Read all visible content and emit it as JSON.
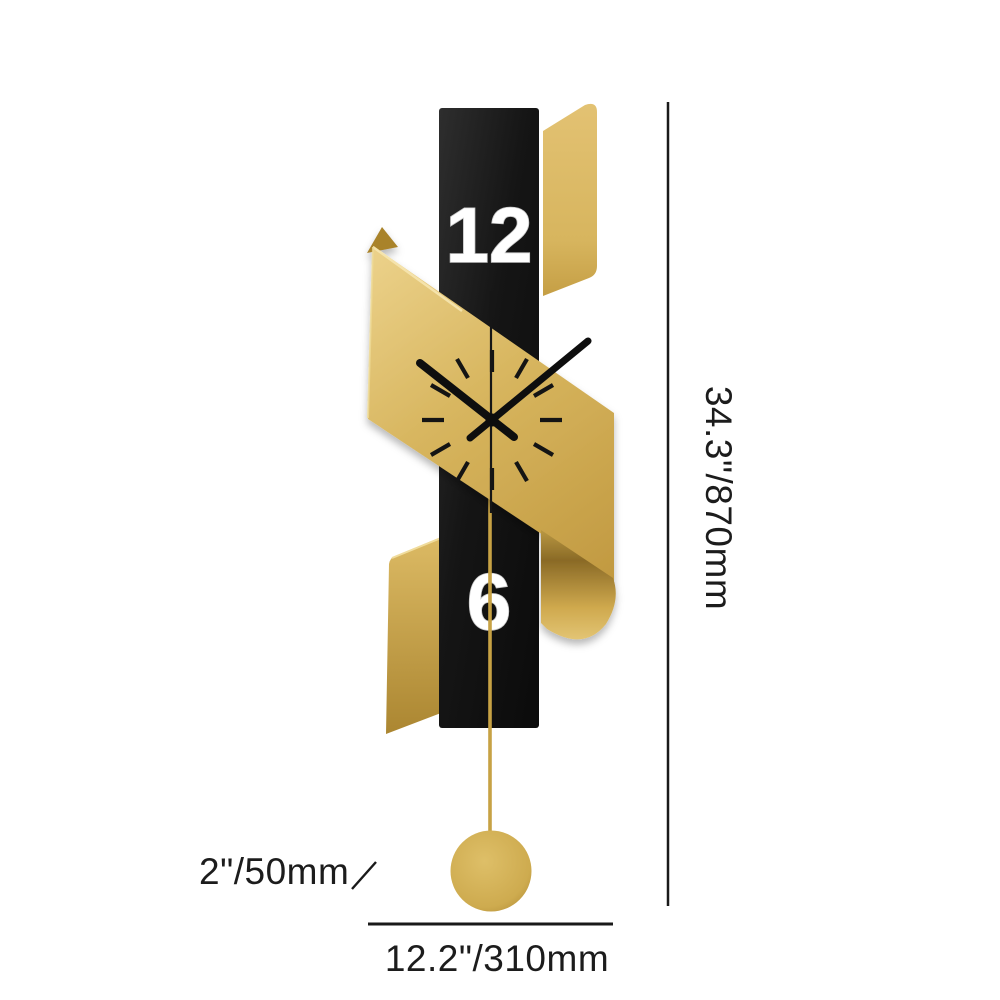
{
  "clock": {
    "numeral_top": "12",
    "numeral_bottom": "6",
    "colors": {
      "gold": "#d2ae56",
      "gold_light": "#ecd28b",
      "gold_dark": "#a8832f",
      "body_black": "#141414",
      "numeral_white": "#ffffff"
    }
  },
  "annotations": {
    "height_label": "34.3\"/870mm",
    "width_label": "12.2\"/310mm",
    "pendulum_label": "2\"/50mm",
    "line_color": "#1a1a1a"
  }
}
